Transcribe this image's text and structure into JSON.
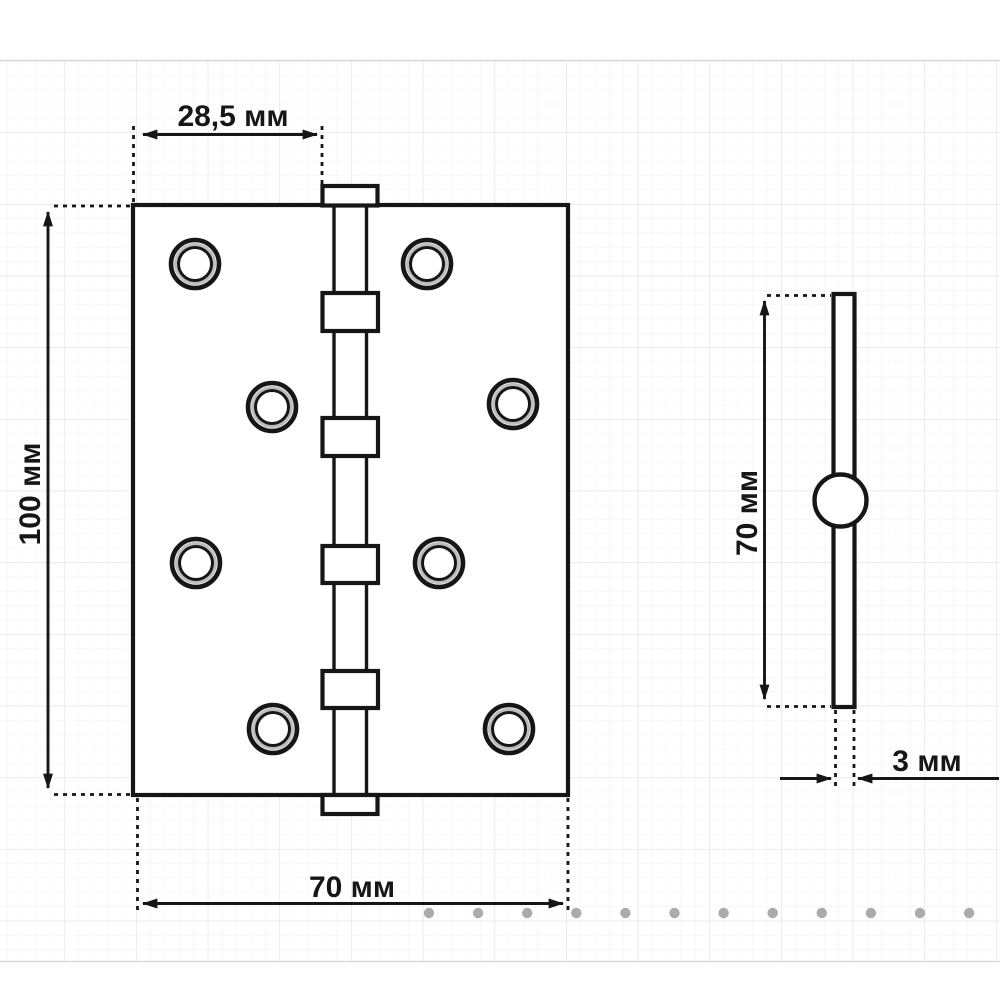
{
  "drawing": {
    "subject": "door-hinge-technical-drawing",
    "units": "мм",
    "line_color": "#161616",
    "front_view": {
      "pin_offset_label": "28,5 мм",
      "height_label": "100 мм",
      "width_label": "70 мм",
      "screw_hole_count": 8,
      "knuckle_count": 4
    },
    "side_view": {
      "height_label": "70 мм",
      "thickness_label": "3 мм"
    }
  },
  "grid": {
    "minor_color": "#f1f1f1",
    "major_color": "#e2e2e2",
    "boundary_color": "#d9d9d9",
    "minor_step": 14.333,
    "major_step": 71.667,
    "top": 60,
    "bottom": 962
  },
  "carousel": {
    "dot_count": 12,
    "dot_color": "#ababab",
    "dot_y": 913,
    "dot_start_x": 429,
    "dot_spacing": 49.1,
    "dot_radius": 5.2
  }
}
